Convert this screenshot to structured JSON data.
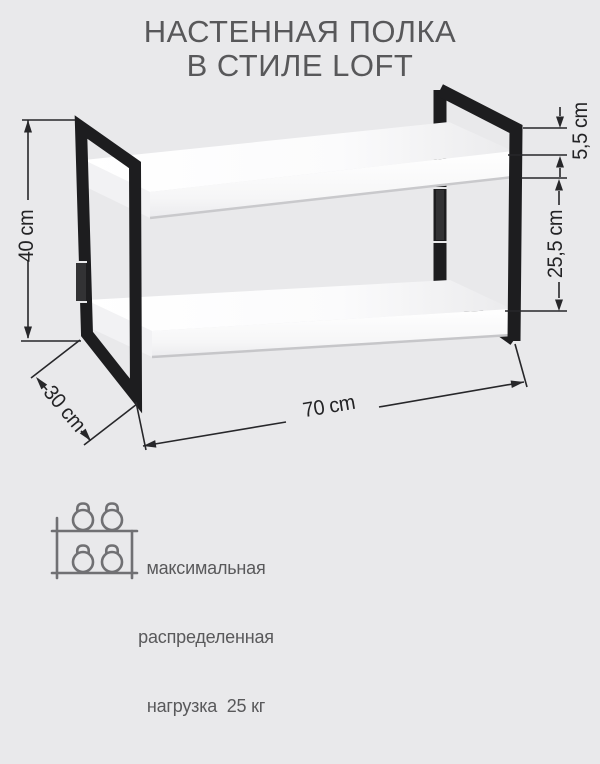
{
  "title": {
    "line1": "НАСТЕННАЯ ПОЛКА",
    "line2": "В СТИЛЕ LOFT"
  },
  "dimensions": {
    "height": "40 cm",
    "depth": "30 cm",
    "width": "70 cm",
    "frame_top_offset": "5,5 cm",
    "shelf_spacing": "25,5 cm"
  },
  "load_note": {
    "line1": "максимальная",
    "line2": "распределенная",
    "line3": "нагрузка  25 кг"
  },
  "icon": {
    "name": "kettlebells-on-shelf-icon"
  },
  "colors": {
    "background": "#e9e9eb",
    "frame": "#1d1d1f",
    "shelf": "#fdfdfe",
    "dimension_lines": "#27272a",
    "title_text": "#58585a",
    "note_text": "#59595b",
    "icon_stroke": "#707073"
  }
}
